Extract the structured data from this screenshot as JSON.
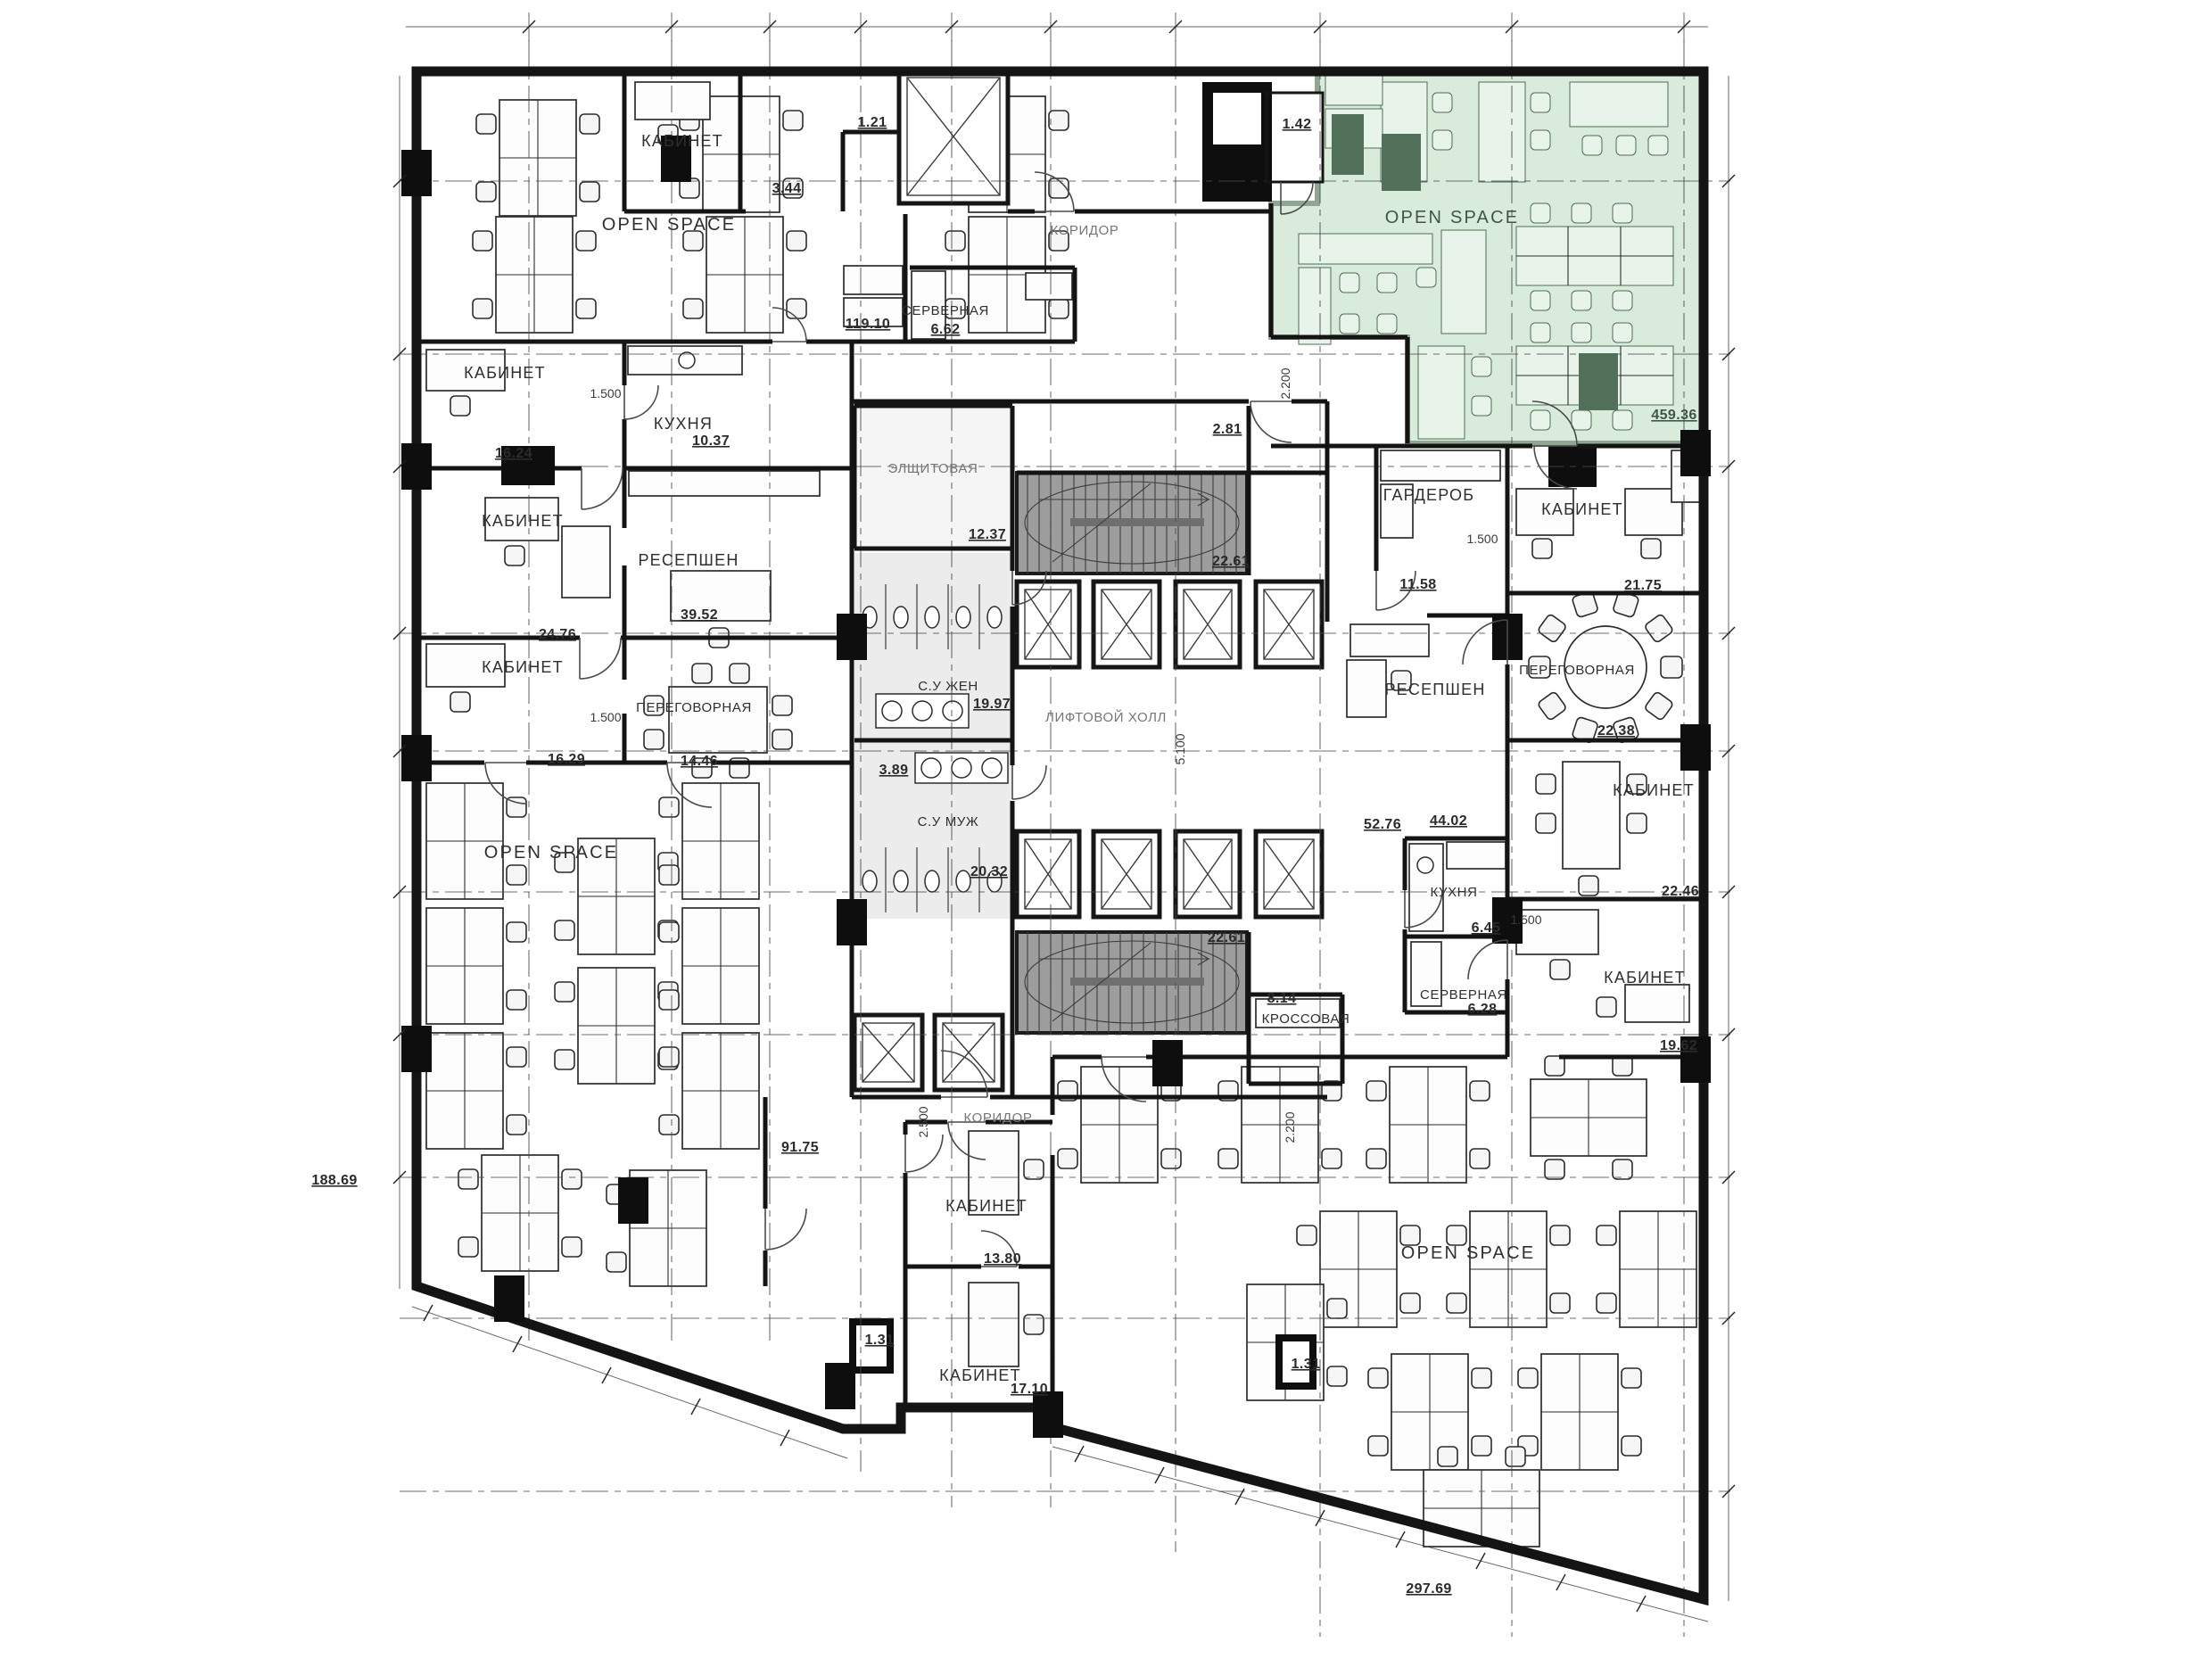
{
  "plan": {
    "type": "office-floor-plan",
    "highlight_color": "#d9ecdc",
    "highlight_border": "#8fa791"
  },
  "rooms": {
    "osTopLeft": {
      "label": "OPEN SPACE",
      "area": "119.10"
    },
    "srvTop": {
      "label": "СЕРВЕРНАЯ",
      "area": "6.62"
    },
    "kabTop": {
      "label": "КАБИНЕТ"
    },
    "a121": {
      "area": "1.21"
    },
    "a344": {
      "area": "3.44"
    },
    "korTop": {
      "label": "КОРИДОР"
    },
    "kabL1": {
      "label": "КАБИНЕТ",
      "area": "16.24"
    },
    "kitchenL": {
      "label": "КУХНЯ",
      "area": "10.37"
    },
    "kabL2": {
      "label": "КАБИНЕТ",
      "area": "24.76"
    },
    "recL": {
      "label": "РЕСЕПШЕН",
      "area": "39.52"
    },
    "kabL3": {
      "label": "КАБИНЕТ",
      "area": "16.29"
    },
    "pereL": {
      "label": "ПЕРЕГОВОРНАЯ",
      "area": "14.46"
    },
    "osLeft": {
      "label": "OPEN SPACE",
      "area": "188.69"
    },
    "elsh": {
      "label": "ЭЛЩИТОВАЯ",
      "area": "12.37"
    },
    "stairT": {
      "area": "22.61"
    },
    "a281": {
      "area": "2.81"
    },
    "suZhen": {
      "label": "С.У ЖЕН",
      "area": "19.97"
    },
    "suMuzh": {
      "label": "С.У МУЖ",
      "area": "20.32"
    },
    "a389": {
      "area": "3.89"
    },
    "liftHall": {
      "label": "ЛИФТОВОЙ ХОЛЛ"
    },
    "stairB": {
      "area": "22.61"
    },
    "korB": {
      "label": "КОРИДОР"
    },
    "a9175": {
      "area": "91.75"
    },
    "kabB1": {
      "label": "КАБИНЕТ",
      "area": "13.80"
    },
    "kabB2": {
      "label": "КАБИНЕТ",
      "area": "17.10"
    },
    "a131L": {
      "area": "1.31"
    },
    "a131R": {
      "area": "1.31"
    },
    "osGreen": {
      "label": "OPEN SPACE",
      "area": "459.36"
    },
    "a142": {
      "area": "1.42"
    },
    "gard": {
      "label": "ГАРДЕРОБ",
      "area": "11.58"
    },
    "kabR1": {
      "label": "КАБИНЕТ",
      "area": "21.75"
    },
    "recR": {
      "label": "РЕСЕПШЕН",
      "area": "44.02"
    },
    "a5276": {
      "area": "52.76"
    },
    "pereR": {
      "label": "ПЕРЕГОВОРНАЯ",
      "area": "22.38"
    },
    "kabR2": {
      "label": "КАБИНЕТ",
      "area": "22.46"
    },
    "kitchenR": {
      "label": "КУХНЯ",
      "area": "6.45"
    },
    "kabR3": {
      "label": "КАБИНЕТ",
      "area": "19.62"
    },
    "srvR": {
      "label": "СЕРВЕРНАЯ",
      "area": "6.28"
    },
    "kross": {
      "label": "КРОССОВАЯ",
      "area": "8.14"
    },
    "osBottom": {
      "label": "OPEN SPACE",
      "area": "297.69"
    }
  },
  "dimensions": {
    "dA": "1.500",
    "dB": "1.500",
    "dC": "1.500",
    "dD": "1.500",
    "dE": "2.200",
    "dF": "2.200",
    "dG": "2.500",
    "dH": "5.100"
  }
}
